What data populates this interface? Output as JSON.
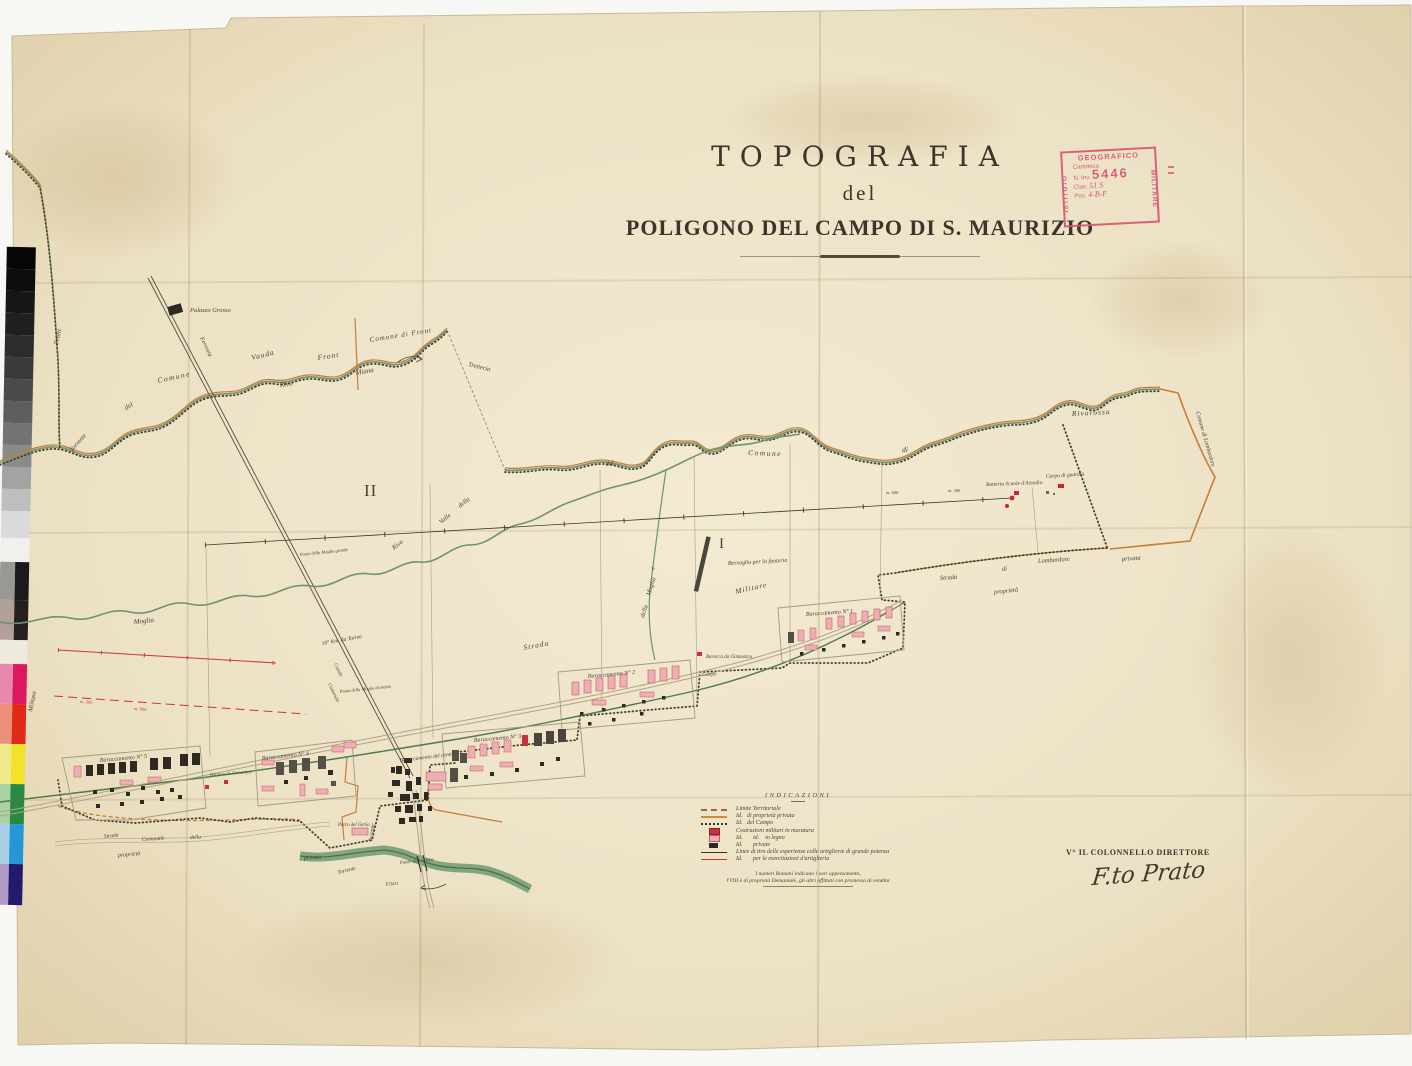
{
  "document": {
    "type": "historical-military-topographic-map",
    "title_line1": "TOPOGRAFIA",
    "title_line2": "del",
    "title_line3": "POLIGONO DEL CAMPO DI S. MAURIZIO"
  },
  "stamp": {
    "top": "GEOGRAFICO",
    "left": "ISTITUTO",
    "right": "MILITARE",
    "row1": "Cartoteca",
    "row2_label": "N. Inv.",
    "row2_value": "5446",
    "row3_label": "Clas.",
    "row3_value": "51 S",
    "row4_label": "Pos.",
    "row4_value": "4-B-F",
    "color": "#d85672"
  },
  "legend": {
    "heading": "INDICAZIONI",
    "items": [
      {
        "swatch": "line-territorial",
        "label": "Limite Territoriale"
      },
      {
        "swatch": "line-orange",
        "label": "Id.   di proprietà privata"
      },
      {
        "swatch": "line-dotted",
        "label": "Id.   del Campo"
      },
      {
        "swatch": "rect-red",
        "label": "Costruzioni militari in muratura"
      },
      {
        "swatch": "rect-pink",
        "label": "Id.       id.    in legno"
      },
      {
        "swatch": "rect-black",
        "label": "Id.       private"
      },
      {
        "swatch": "line-black",
        "label": "Linee di tiro delle esperienze colle artiglierie di grande potenza"
      },
      {
        "swatch": "line-red",
        "label": "Id.       per le esercitazioni d'artiglieria"
      }
    ],
    "note_line1": "I numeri Romani indicano i vari appezzamenti,",
    "note_line2": "l'VIII è di proprietà Demaniale, gli altri affittati con promessa di vendita"
  },
  "signature": {
    "heading": "V° IL COLONNELLO DIRETTORE",
    "name": "F.to Prato"
  },
  "map": {
    "plots": {
      "numeral_1": "I",
      "numeral_2": "II"
    },
    "labels": {
      "palazzo_grosso": "Palazzo Grosso",
      "ferrovia": "Ferrovia",
      "comune": "Comune",
      "di": "di",
      "del": "del",
      "della": "della",
      "e": "e",
      "front": "Front",
      "vauda": "Vauda",
      "miana": "Miana",
      "rivo": "Rivo",
      "valle": "Valle",
      "moglia": "Moglia",
      "torrente": "Torrente",
      "comune_di_front": "Comune di Front",
      "treiteria": "Treiteria",
      "rivarossa": "Rivarossa",
      "comune_di_lombardore": "Comune di Lombardore",
      "strada": "Strada",
      "militare": "Militare",
      "lombardore": "Lombardore",
      "comunale": "Comunale",
      "canale": "Canale",
      "campo": "Campo",
      "privata": "privata",
      "proprieta": "proprietà",
      "bersaglio": "Bersaglio per la fanteria",
      "batteria": "Batteria Scuole d'Assedio",
      "corpo_guardia": "Corpo di guardia",
      "baraccamento_1": "Baraccamento N° 1",
      "baraccamento_2": "Baraccamento N° 2",
      "baraccamento_3": "Baraccamento N° 3",
      "baraccamento_4": "Baraccamento N° 4",
      "baraccamento_5": "Baraccamento N° 5",
      "baraccamento_centro": "Baraccamento del centro",
      "baracca_ginnastica": "Baracca da Ginnastica",
      "parco_genio": "Parco del Genio",
      "ponte_fisca": "Ponte della Fisca",
      "fisca": "Fisca",
      "ponte_moglia_grande": "Ponte della Moglia grande",
      "ponte_moglia_mezzo": "Ponte della Moglia di mezzo",
      "km_torino": "10° Km. da Torino",
      "dist_300": "m. 300",
      "dist_600": "m. 600"
    },
    "colors": {
      "paper": "#ece1c4",
      "ink": "#3a342a",
      "boundary_green": "#7a9472",
      "boundary_orange": "#c87c38",
      "river_green": "#6f936c",
      "building_red": "#cc2f3d",
      "building_pink": "#eeafb4",
      "firing_red": "#cc3538"
    }
  }
}
